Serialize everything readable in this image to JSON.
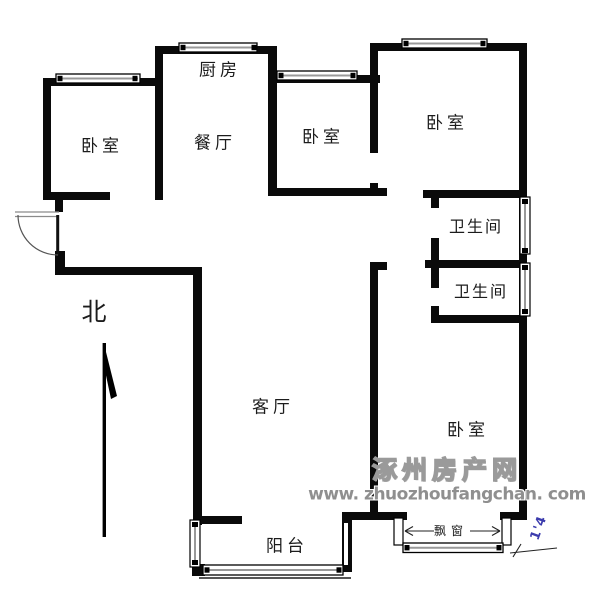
{
  "floorplan": {
    "rooms": {
      "bedroom_nw": "卧室",
      "kitchen": "厨房",
      "dining": "餐厅",
      "bedroom_n": "卧室",
      "bedroom_ne": "卧室",
      "bathroom_upper": "卫生间",
      "bathroom_lower": "卫生间",
      "living": "客厅",
      "bedroom_se": "卧室",
      "balcony": "阳台"
    },
    "annotations": {
      "north": "北",
      "bay_window": "飘窗",
      "bay_window_dimension": "1'4"
    },
    "watermark": {
      "site_name": "涿州房产网",
      "site_url": "www. zhuozhoufangchan. com"
    },
    "colors": {
      "wall": "#0a0a0a",
      "window_line": "#999999",
      "dimension_text": "#3b3bad",
      "watermark": "#9a9a9a"
    }
  }
}
